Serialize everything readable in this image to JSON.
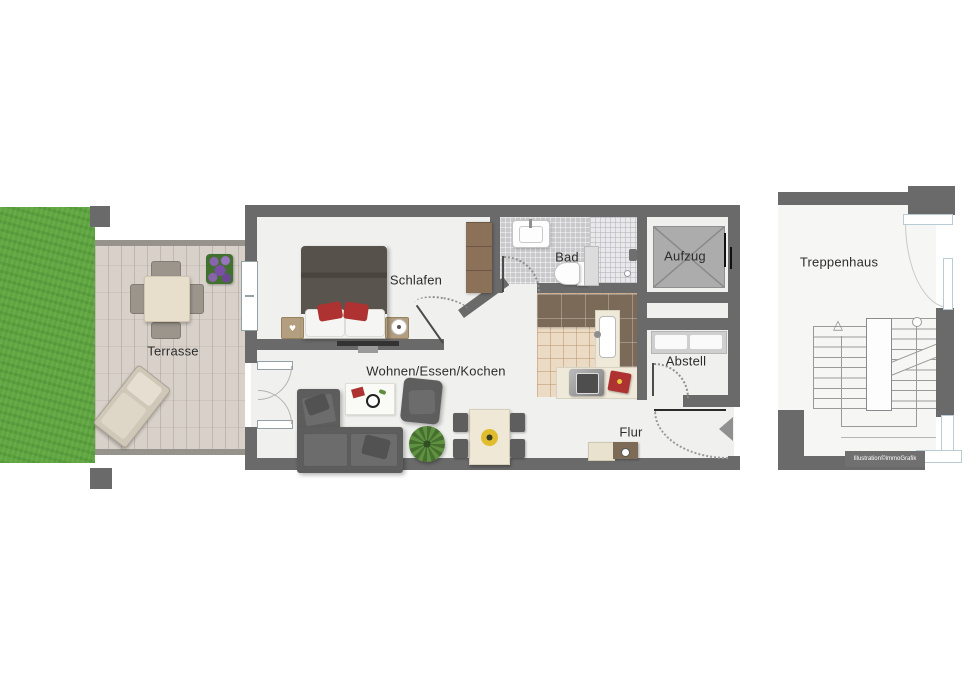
{
  "floorplan": {
    "rooms": {
      "terrasse": {
        "label": "Terrasse"
      },
      "schlafen": {
        "label": "Schlafen"
      },
      "bad": {
        "label": "Bad"
      },
      "aufzug": {
        "label": "Aufzug"
      },
      "abstell": {
        "label": "Abstell"
      },
      "wohnen_essen_kochen": {
        "label": "Wohnen/Essen/Kochen"
      },
      "flur": {
        "label": "Flur"
      },
      "treppenhaus": {
        "label": "Treppenhaus"
      }
    },
    "watermark": "Illustration©ImmoGrafik",
    "icons": {
      "stairs_up_arrow": "△",
      "nightstand_heart": "♥"
    },
    "colors": {
      "wall": "#6a6a6a",
      "interior_floor": "#f0f0ee",
      "grass": "#5fa540",
      "terrace_paving": "#d8d1ca",
      "elevator_fill": "#acacac",
      "bathroom_tile": "#c9c9cb",
      "shower_tile": "#e9e9eb",
      "kitchen_tile": "#ebdbc5",
      "counter_wood": "#7b6a58",
      "wardrobe_wood": "#8b7157",
      "sofa_gray": "#5d5d5d",
      "bed_duvet": "#56514b",
      "accent_red": "#ae3231",
      "window_frame": "#b9ccd3"
    }
  }
}
